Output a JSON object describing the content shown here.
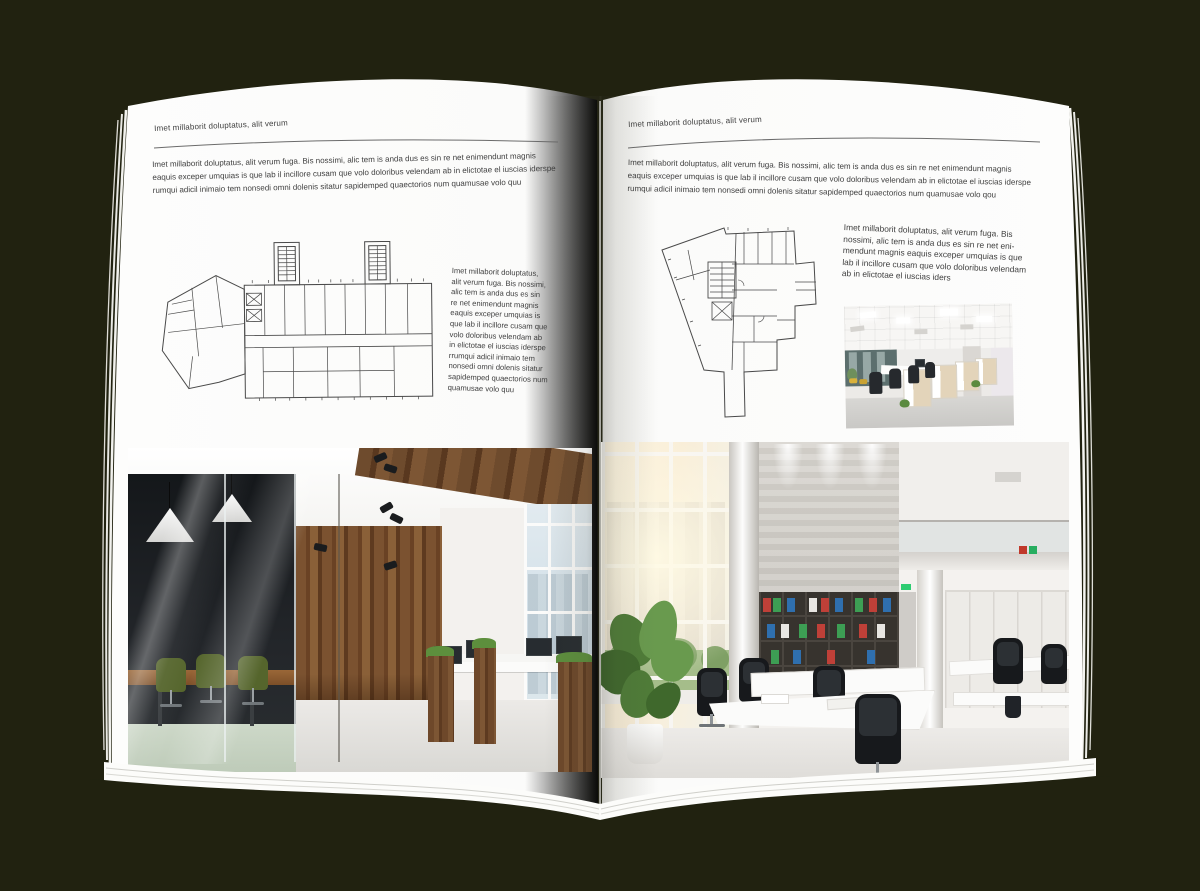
{
  "canvas": {
    "background": "#212210"
  },
  "left_page": {
    "header": "Imet millaborit doluptatus, alit verum",
    "intro_lines": [
      "Imet millaborit doluptatus, alit verum fuga. Bis nossimi, alic tem is anda dus es sin re net enimendunt magnis",
      "eaquis exceper umquias is que lab il incillore cusam que volo doloribus velendam ab in elictotae el iuscias iderspe",
      "rumqui adicil inimaio tem nonsedi omni dolenis sitatur sapidemped quaectorios num quamusae volo quu"
    ],
    "side_lines": [
      "Imet millaborit doluptatus,",
      "alit verum fuga. Bis nossimi,",
      "alic tem is anda dus es sin",
      "re net enimendunt magnis",
      "eaquis exceper umquias is",
      "que lab il incillore cusam que",
      "volo doloribus velendam ab",
      "in elictotae el iuscias iderspe",
      "rrumqui adicil inimaio tem",
      "nonsedi omni dolenis sitatur",
      "sapidemped quaectorios num",
      "quamusae volo quu"
    ]
  },
  "right_page": {
    "header": "Imet millaborit doluptatus, alit verum",
    "intro_lines": [
      "Imet millaborit doluptatus, alit verum fuga. Bis nossimi, alic tem is anda dus es sin re net enimendunt magnis",
      "eaquis exceper umquias is que lab il incillore cusam que volo doloribus velendam ab in elictotae el iuscias iderspe",
      "rumqui adicil inimaio tem nonsedi omni dolenis sitatur sapidemped quaectorios num quamusae volo qou"
    ],
    "side_lines": [
      "Imet millaborit doluptatus, alit verum fuga. Bis",
      "nossimi, alic tem is anda dus es sin re net eni-",
      "mendunt magnis eaquis exceper umquias is que",
      "lab il incillore cusam que volo doloribus velendam",
      "ab in elictotae el iuscias iders"
    ]
  },
  "images": {
    "left_floor_plan": "architectural floor plan of rectangular office building with two stair towers and angled left wing",
    "right_floor_plan": "architectural floor plan of irregular triangular office building with bottom stem",
    "left_large_photo": "loft style office interior with dark glass meeting room, green chairs, wood plank wall and workstations",
    "right_large_photo": "bright double-height open office with tall sunny windows, concrete feature wall, binder bookshelf and white desks",
    "right_small_photo": "modern office open space with rows of white and wood workstations and black chairs"
  },
  "palette": {
    "background": "#212210",
    "page": "#fcfcfb",
    "text": "#3d3d3d",
    "plan_line": "#4a4a4a",
    "wood": "#7b5230",
    "chair_green": "#55652c",
    "binder_red": "#bf4038",
    "binder_green": "#3d9e54",
    "binder_blue": "#2f6fae"
  }
}
